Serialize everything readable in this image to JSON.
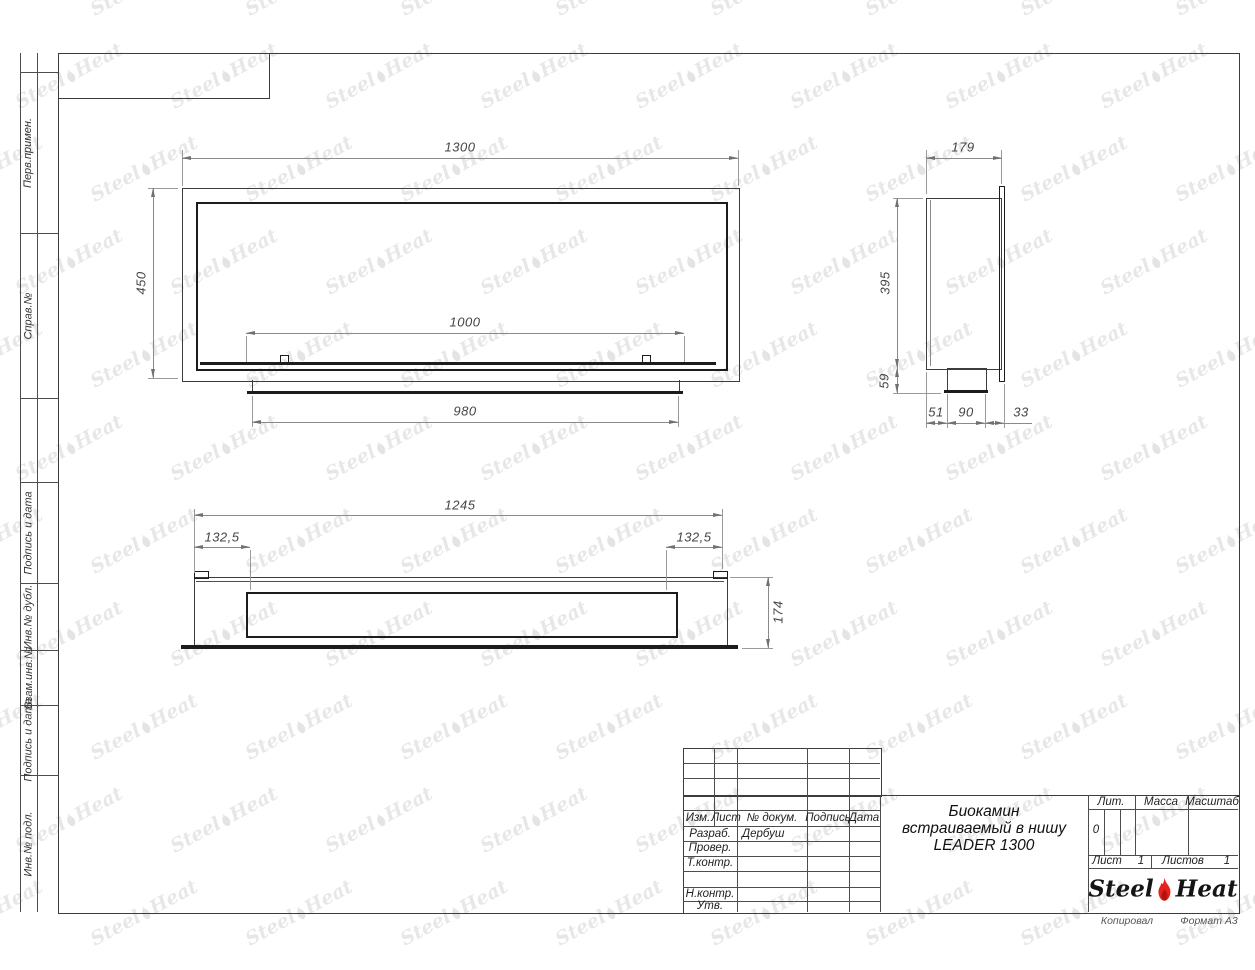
{
  "margin": {
    "labels": [
      "Перв.примен.",
      "Справ.№",
      "Подпись и дата",
      "Инв.№ дубл.",
      "Взам.инв.№",
      "Подпись и дата",
      "Инв.№ подл."
    ]
  },
  "views": {
    "front": {
      "width": "1300",
      "height": "450",
      "opening_width": "1000",
      "base_width": "980"
    },
    "side": {
      "depth": "179",
      "height": "395",
      "tray_height": "59",
      "offset_back": "51",
      "tray_depth": "90",
      "offset_front": "33"
    },
    "plan": {
      "width": "1245",
      "inset_left": "132,5",
      "inset_right": "132,5",
      "depth": "174"
    }
  },
  "title_block": {
    "header": {
      "izm": "Изм.",
      "list": "Лист",
      "doc": "№ докум.",
      "sign": "Подпись",
      "date": "Дата"
    },
    "rows": [
      {
        "label": "Разраб.",
        "value": "Дербуш"
      },
      {
        "label": "Провер.",
        "value": ""
      },
      {
        "label": "Т.контр.",
        "value": ""
      },
      {
        "label": "",
        "value": ""
      },
      {
        "label": "Н.контр.",
        "value": ""
      },
      {
        "label": "Утв.",
        "value": ""
      }
    ],
    "title_lines": [
      "Биокамин",
      "встраиваемый в нишу",
      "LEADER 1300"
    ],
    "lit": {
      "header": "Лит.",
      "value": "0"
    },
    "massa": {
      "header": "Масса",
      "value": ""
    },
    "masshtab": {
      "header": "Масштаб",
      "value": ""
    },
    "sheet_no": {
      "label": "Лист",
      "value": "1"
    },
    "sheets_total": {
      "label": "Листов",
      "value": "1"
    },
    "logo": {
      "steel": "Steel",
      "heat": "Heat",
      "flame_color": "#e8211d"
    }
  },
  "footer": {
    "copied": "Копировал",
    "format": "Формат А3"
  },
  "watermark": {
    "steel": "Steel",
    "heat": "Heat",
    "color": "#bdbdbd"
  }
}
